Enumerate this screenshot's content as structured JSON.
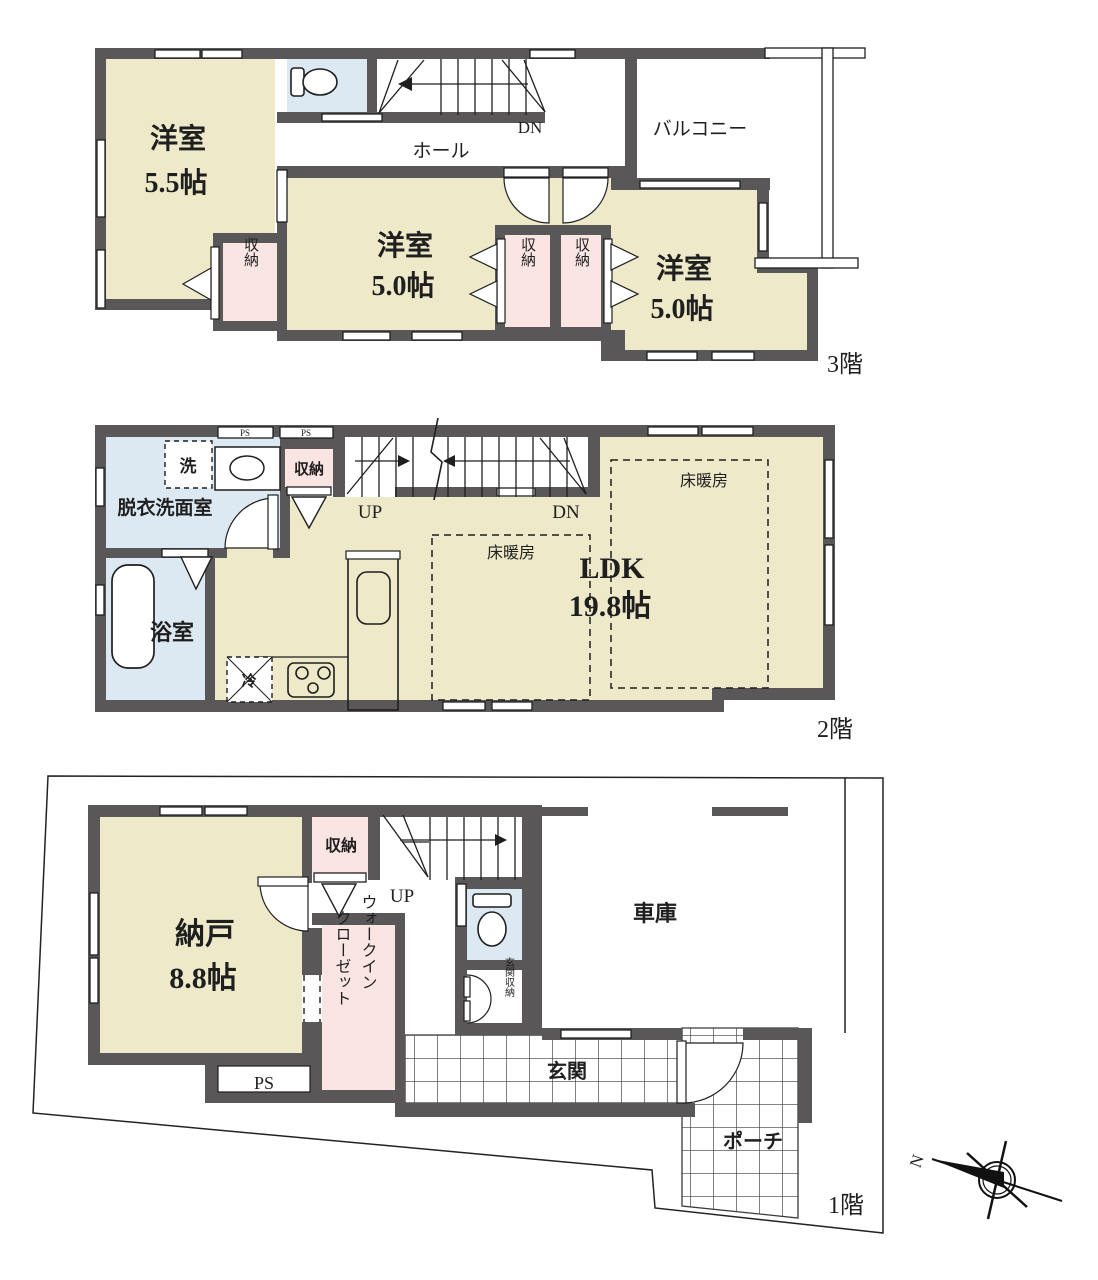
{
  "title": "3-story house floor plan",
  "colors": {
    "wall": "#595757",
    "room_cream": "#EDE9C9",
    "closet_pink": "#FAE5E3",
    "wet_blue": "#DCE9F2",
    "line": "#1f1f1f"
  },
  "floor3": {
    "label": "3階",
    "room1_name": "洋室",
    "room1_size": "5.5帖",
    "room2_name": "洋室",
    "room2_size": "5.0帖",
    "room3_name": "洋室",
    "room3_size": "5.0帖",
    "closet": "収納",
    "hall": "ホール",
    "dn": "DN",
    "balcony": "バルコニー"
  },
  "floor2": {
    "label": "2階",
    "washroom": "脱衣洗面室",
    "washer": "洗",
    "closet": "収納",
    "up": "UP",
    "dn": "DN",
    "floor_heating": "床暖房",
    "ldk_name": "LDK",
    "ldk_size": "19.8帖",
    "bath": "浴室",
    "fridge": "冷",
    "ps": "PS"
  },
  "floor1": {
    "label": "1階",
    "storage_name": "納戸",
    "storage_size": "8.8帖",
    "closet": "収納",
    "up": "UP",
    "garage": "車庫",
    "wic_line1": "ウォークイン",
    "wic_line2": "クローゼット",
    "entrance_storage": "玄関収納",
    "entrance": "玄関",
    "porch": "ポーチ",
    "ps": "PS",
    "north": "N"
  }
}
